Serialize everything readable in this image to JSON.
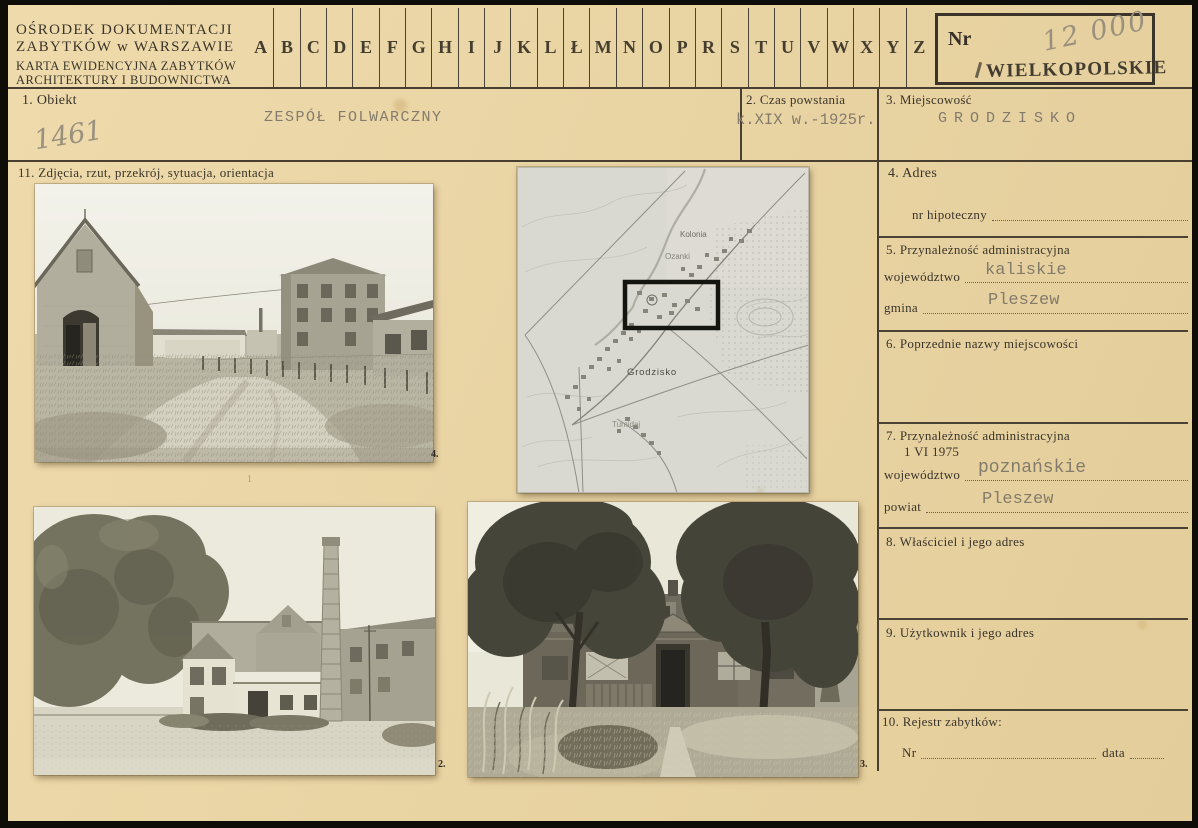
{
  "colors": {
    "paper": "#e9d4a4",
    "scan_edge": "#0f0d08",
    "ink_print": "#3a342a",
    "ink_typewriter": "#837b6b",
    "pencil": "#99907e",
    "stamp": "#423c30",
    "rule_line": "#483f30"
  },
  "header": {
    "org_line1": "OŚRODEK DOKUMENTACJI",
    "org_line2": "ZABYTKÓW w WARSZAWIE",
    "card_line1": "KARTA EWIDENCYJNA ZABYTKÓW",
    "card_line2": "ARCHITEKTURY I BUDOWNICTWA",
    "alphabet": [
      "A",
      "B",
      "C",
      "D",
      "E",
      "F",
      "G",
      "H",
      "I",
      "J",
      "K",
      "L",
      "Ł",
      "M",
      "N",
      "O",
      "P",
      "R",
      "S",
      "T",
      "U",
      "V",
      "W",
      "X",
      "Y",
      "Z"
    ],
    "nr_label": "Nr",
    "nr_value_pencil": "12 000",
    "voivodeship_stamp": "WIELKOPOLSKIE"
  },
  "fields": {
    "f1": {
      "label": "1. Obiekt",
      "value": "ZESPÓŁ FOLWARCZNY",
      "pencil_note": "1461"
    },
    "f2": {
      "label": "2. Czas powstania",
      "value": "k.XIX w.-1925r."
    },
    "f3": {
      "label": "3. Miejscowość",
      "value": "GRODZISKO"
    },
    "f4": {
      "label": "4. Adres",
      "sub_label": "nr hipoteczny"
    },
    "f5": {
      "label": "5. Przynależność administracyjna",
      "rows": [
        {
          "label": "województwo",
          "value": "kaliskie"
        },
        {
          "label": "gmina",
          "value": "Pleszew"
        }
      ]
    },
    "f6": {
      "label": "6. Poprzednie nazwy miejscowości"
    },
    "f7": {
      "label": "7. Przynależność administracyjna",
      "label2": "1 VI 1975",
      "rows": [
        {
          "label": "województwo",
          "value": "poznańskie"
        },
        {
          "label": "powiat",
          "value": "Pleszew"
        }
      ]
    },
    "f8": {
      "label": "8. Właściciel i jego adres"
    },
    "f9": {
      "label": "9. Użytkownik i jego adres"
    },
    "f10": {
      "label": "10. Rejestr zabytków:",
      "nr_label": "Nr",
      "data_label": "data"
    },
    "f11": {
      "label": "11. Zdjęcia, rzut, przekrój, sytuacja, orientacja"
    }
  },
  "photos": {
    "photo1": {
      "caption": "4.",
      "page_mark": "1",
      "description": "farm yard with barn, dirt road and brick granary"
    },
    "photo2": {
      "caption": "2.",
      "description": "mill complex with tall chimney and poplar trees"
    },
    "photo3": {
      "caption": "3.",
      "description": "manor house behind two large trees, overgrown garden"
    },
    "map": {
      "labels": {
        "kolonia": "Kolonia",
        "ozanki": "Ozanki",
        "grodzisko": "Grodzisko",
        "tumidaj": "Tumidaj"
      },
      "marker": "site-rectangle"
    }
  }
}
